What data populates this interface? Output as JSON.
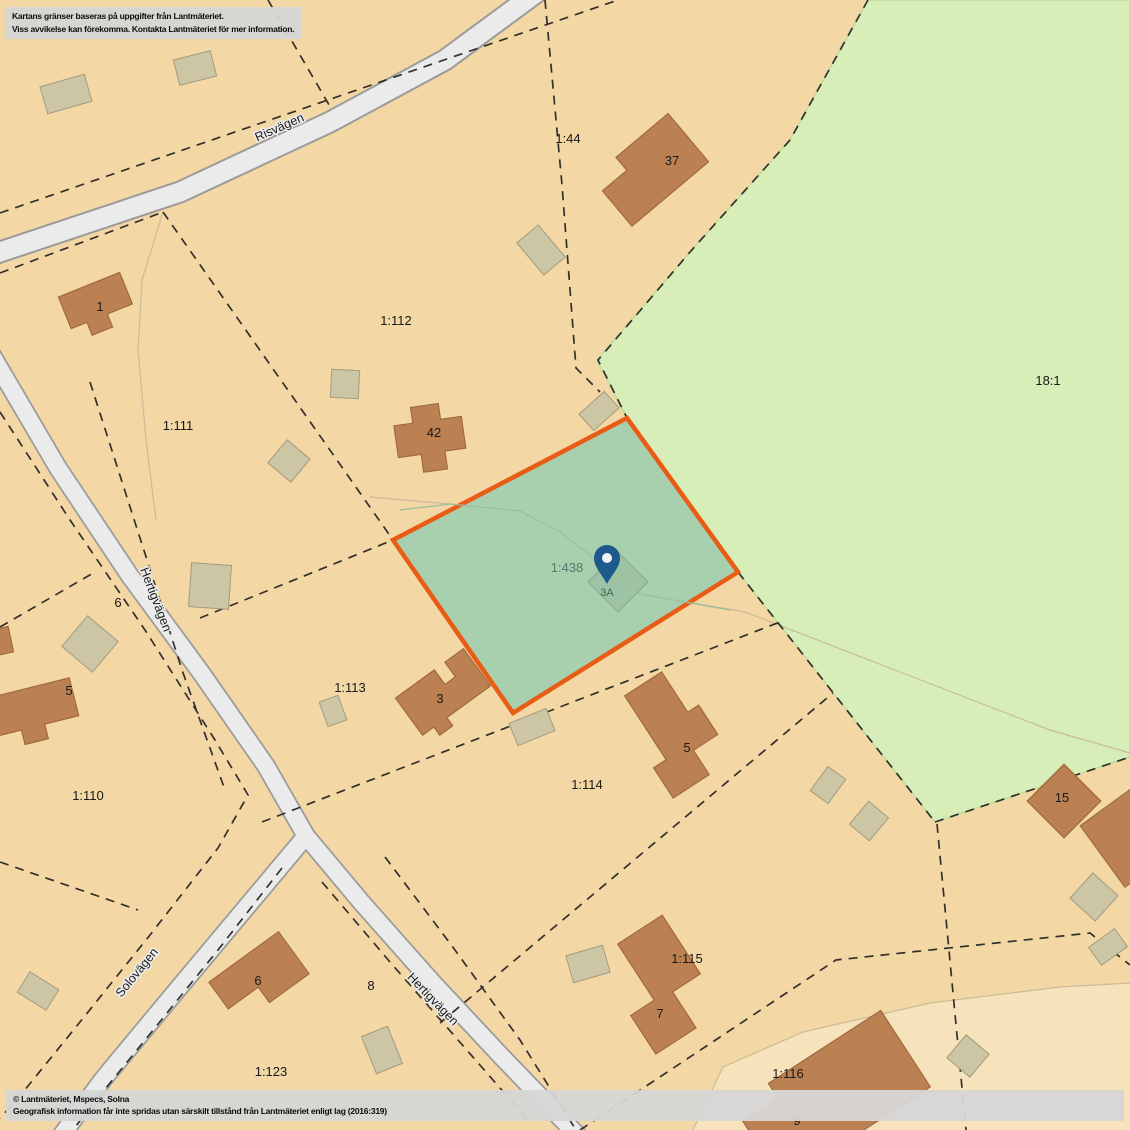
{
  "notices": {
    "top_line1": "Kartans gränser baseras på uppgifter från Lantmäteriet.",
    "top_line2": "Viss avvikelse kan förekomma. Kontakta Lantmäteriet för mer information.",
    "bottom_line1": "© Lantmäteriet, Mspecs, Solna",
    "bottom_line2": "Geografisk information får inte spridas utan särskilt tillstånd från Lantmäteriet enligt lag (2016:319)"
  },
  "roads": {
    "risvagen": "Risvägen",
    "hertigvagen_upper": "Hertigvägen",
    "solovagen": "Solovägen",
    "hertigvagen_lower": "Hertigvägen"
  },
  "selected": {
    "parcel_id": "1:438",
    "marker_label": "3A"
  },
  "parcels": {
    "p1_44": "1:44",
    "p1_112": "1:112",
    "p1_111": "1:111",
    "p18_1": "18:1",
    "p1_110": "1:110",
    "p1_113": "1:113",
    "p1_114": "1:114",
    "p1_115": "1:115",
    "p1_116": "1:116",
    "p1_123": "1:123"
  },
  "house_numbers": {
    "h37": "37",
    "h1": "1",
    "h42": "42",
    "h3": "3",
    "h5_center": "5",
    "h5_left": "5",
    "h6_left": "6",
    "h6_bottom": "6",
    "h8": "8",
    "h7": "7",
    "h9": "9",
    "h15": "15"
  },
  "colors": {
    "background_parcel": "#f3d7a4",
    "parcel_light": "#f7e3bb",
    "forest_green": "#d7eeb8",
    "selected_fill": "#a8cfae",
    "selected_border": "#e95c16",
    "building_brown": "#bc8152",
    "shed_tan": "#cdc6a5",
    "road_fill": "#ebebeb",
    "pin_blue": "#1e598c"
  }
}
